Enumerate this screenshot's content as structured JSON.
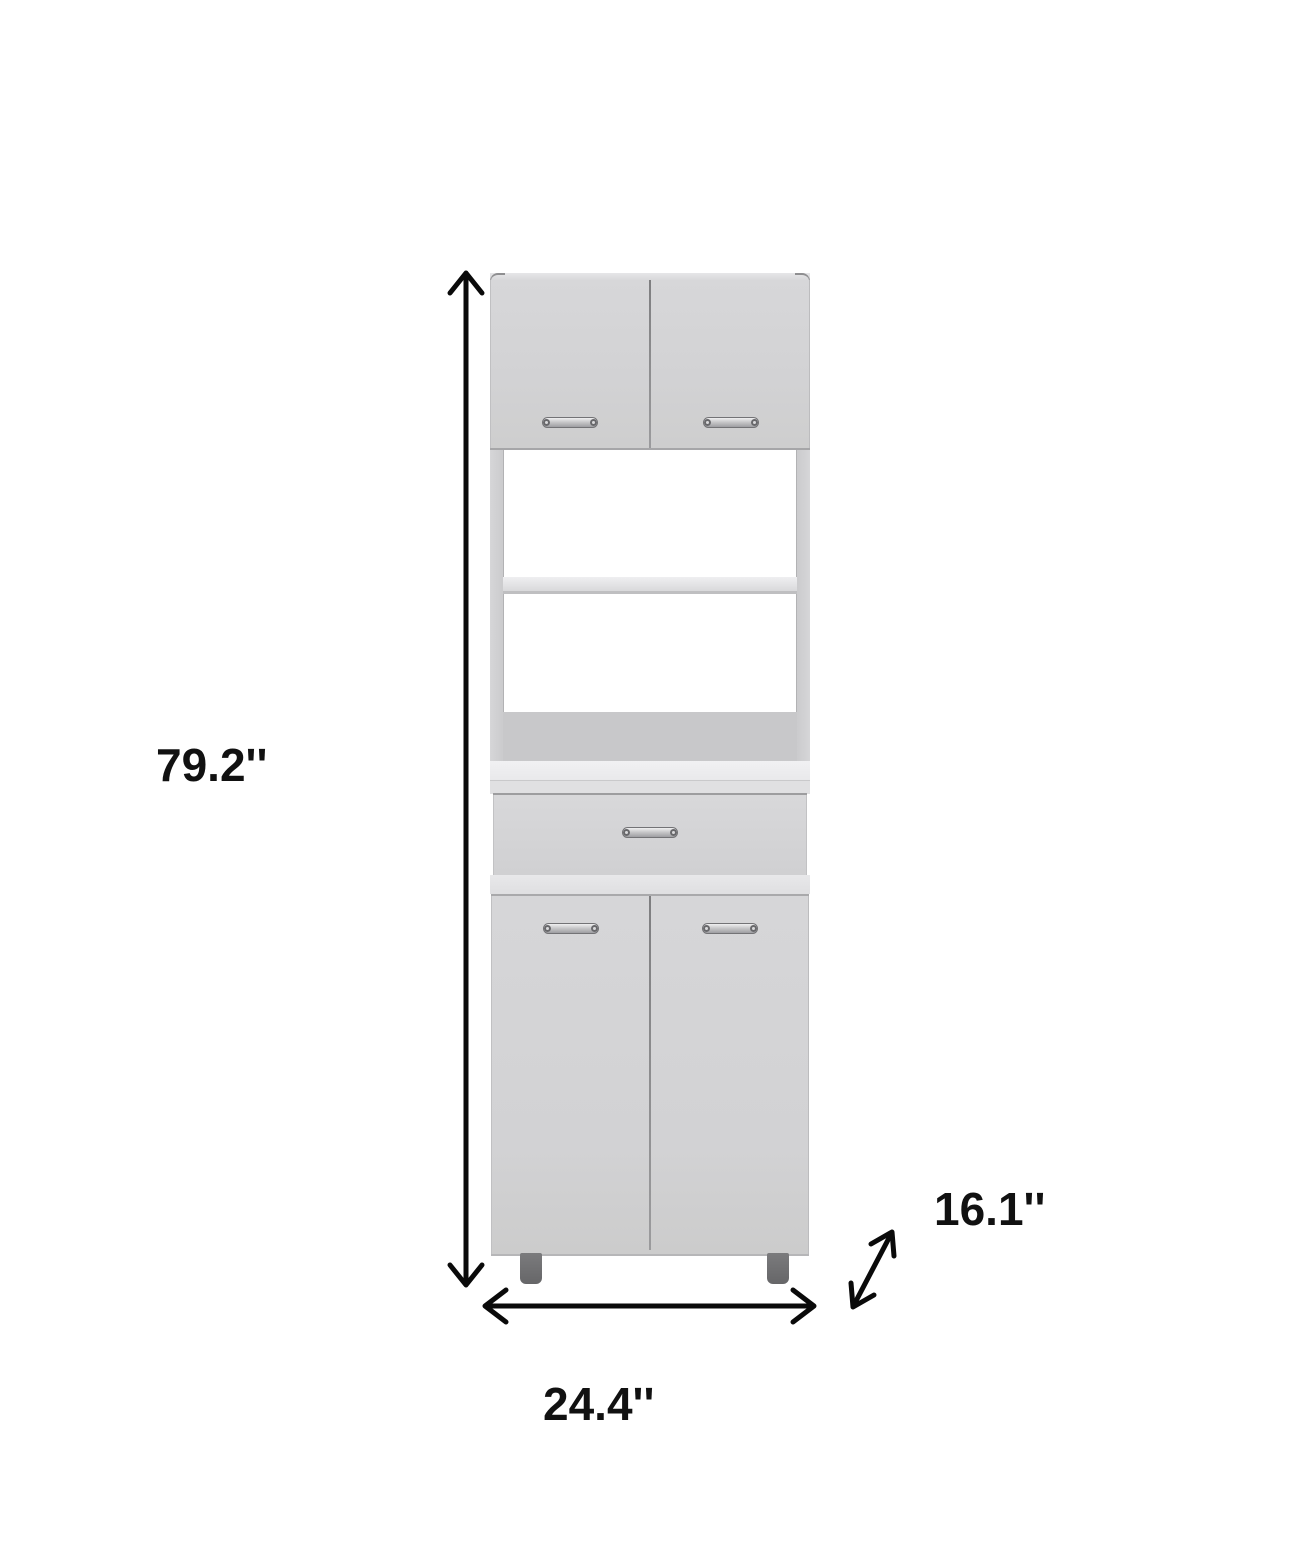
{
  "page": {
    "background_color": "#ffffff"
  },
  "diagram": {
    "kind": "furniture-dimension-diagram",
    "product": "tall pantry microwave cabinet with upper double doors, two open shelves, one drawer, lower double doors and legs",
    "labels": {
      "height": "79.2''",
      "width": "24.4''",
      "depth": "16.1''"
    },
    "colors": {
      "arrow": "#0a0a0a",
      "label_text": "#111111",
      "cabinet_face": "#d2d2d4",
      "cabinet_back_panel": "#c8c8ca",
      "countertop_highlight": "#efeff1",
      "legs": "#6f6f71",
      "handle_metal": "#c9c9cb"
    }
  }
}
